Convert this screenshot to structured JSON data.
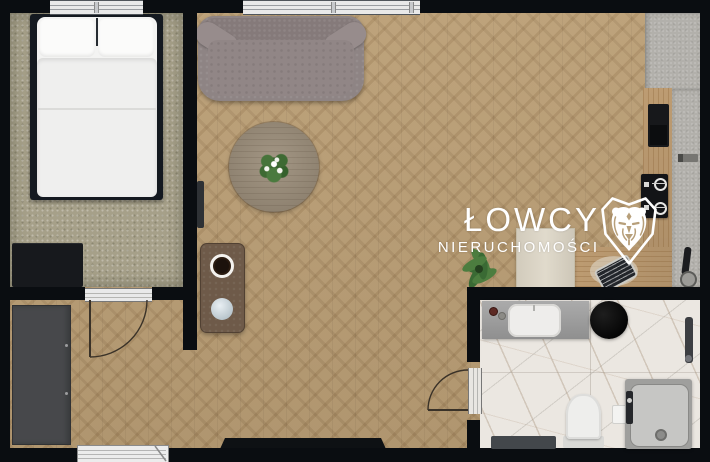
{
  "watermark": {
    "brand_line1": "ŁOWCY",
    "brand_line2": "NIERUCHOMOŚCI",
    "logo": "lion-head-in-heart-shield",
    "color": "#ffffff"
  },
  "palette": {
    "wall": "#0a0d11",
    "wood_floor": "#b79a70",
    "bedroom_carpet": "#a6a089",
    "bathroom_marble": "#ebe7e1",
    "kitchen_concrete": "#b2b0ab",
    "kitchen_wood_counter": "#c7a478",
    "sofa_gray": "#8e8484",
    "shower_gray": "#c6c6c4",
    "accent_dark": "#15181d"
  },
  "scene": {
    "type": "apartment-floor-plan-top-view",
    "rooms": [
      {
        "name": "bedroom",
        "position": "top-left",
        "furniture": [
          "double-bed",
          "dresser",
          "carpet",
          "window"
        ]
      },
      {
        "name": "hallway",
        "position": "bottom-left",
        "furniture": [
          "wardrobe",
          "entrance-door",
          "interior-door"
        ]
      },
      {
        "name": "living-room",
        "position": "center",
        "furniture": [
          "sofa",
          "round-table-with-centerpiece",
          "side-table",
          "floor-shadow-mat",
          "potted-palm",
          "storage-cabinet",
          "radiator",
          "window"
        ]
      },
      {
        "name": "kitchen",
        "position": "right",
        "furniture": [
          "concrete-countertop",
          "wood-countertop",
          "built-in-oven",
          "gas-cooktop",
          "faucet-sink",
          "cutting-board",
          "wall-handle"
        ]
      },
      {
        "name": "bathroom",
        "position": "bottom-right",
        "furniture": [
          "vanity-with-sink",
          "round-black-basin",
          "toilet",
          "shower-enclosure",
          "towel-radiator",
          "bath-mat",
          "door-with-swing"
        ]
      }
    ]
  }
}
